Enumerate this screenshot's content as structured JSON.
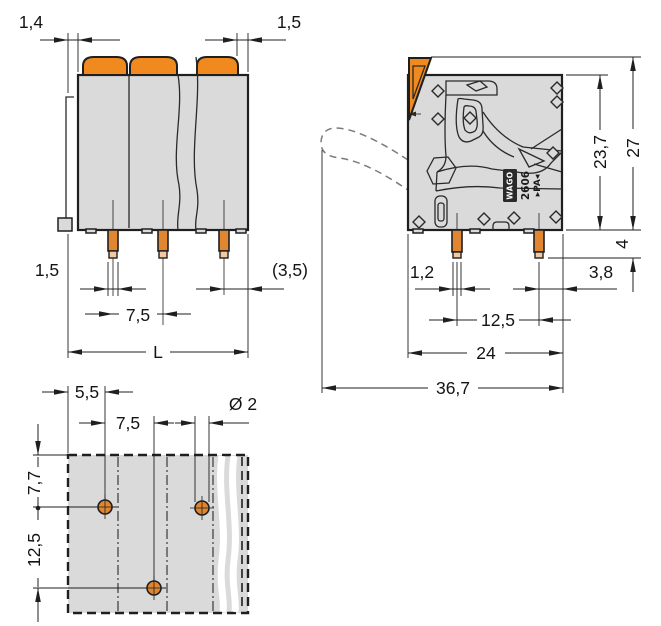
{
  "drawing": {
    "views": {
      "front": {
        "dims": {
          "lever_offset_left": "1,4",
          "lever_offset_right": "1,5",
          "pin_width": "1,5",
          "pin_pitch": "7,5",
          "pin_to_edge": "(3,5)",
          "overall_width": "L"
        }
      },
      "side": {
        "dims": {
          "body_height": "23,7",
          "overall_height": "27",
          "pin_length": "4",
          "pin_width": "1,2",
          "pin_to_edge": "3,8",
          "pin_spacing": "12,5",
          "body_depth": "24",
          "overall_depth": "36,7"
        },
        "marking": {
          "brand": "WAGO",
          "series": "2606",
          "material": "▸PA◂"
        }
      },
      "footprint": {
        "dims": {
          "edge_to_hole": "5,5",
          "hole_pitch": "7,5",
          "hole_diameter": "Ø 2",
          "row_offset": "7,7",
          "row_pitch": "12,5"
        }
      }
    },
    "colors": {
      "accent_orange": "#F08A1E",
      "pin_copper": "#E08530",
      "pin_tip": "#F2C9A2",
      "body_gray": "#DADADA",
      "line": "#1F1F1F"
    }
  }
}
